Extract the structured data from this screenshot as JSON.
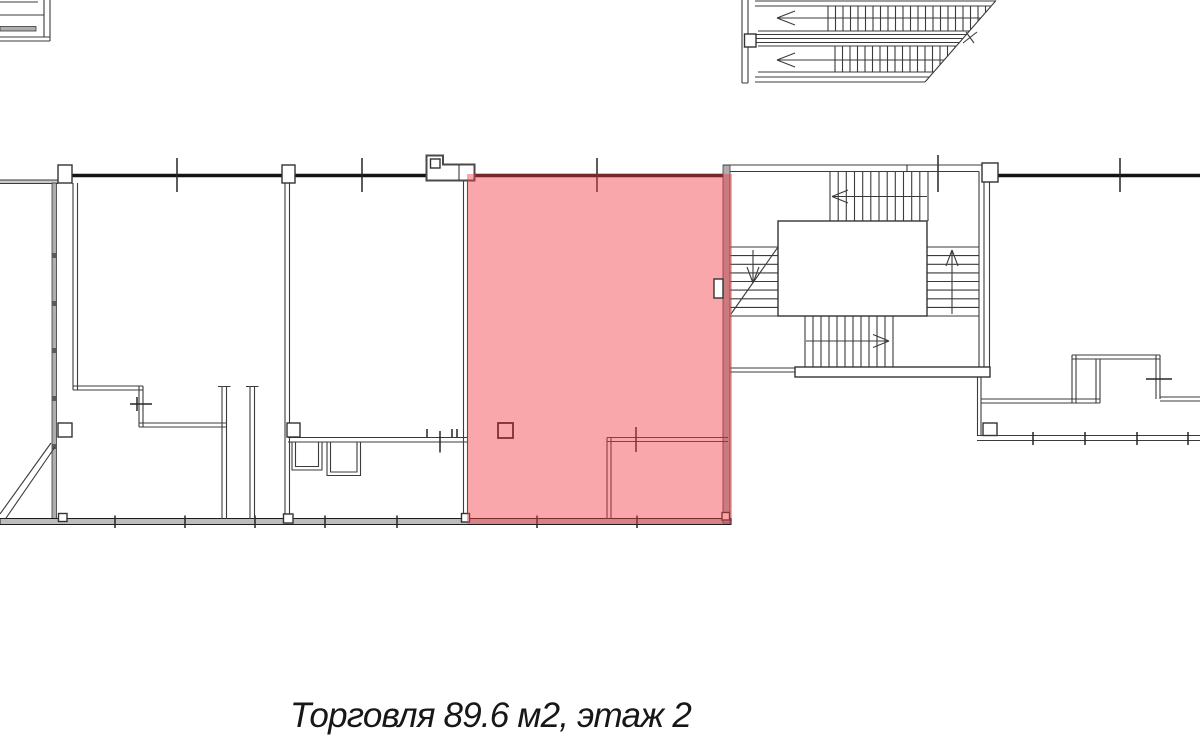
{
  "caption": {
    "text": "Торговля 89.6 м2, этаж 2"
  },
  "unit": {
    "type": "Торговля",
    "area_m2": "89.6",
    "floor": "2"
  },
  "highlight": {
    "fill": "#f23c43",
    "opacity": "0.45"
  },
  "colors": {
    "background": "#ffffff",
    "line_dark": "#141414",
    "line": "#3b3b3b",
    "wall_gray": "#aeaeae"
  }
}
